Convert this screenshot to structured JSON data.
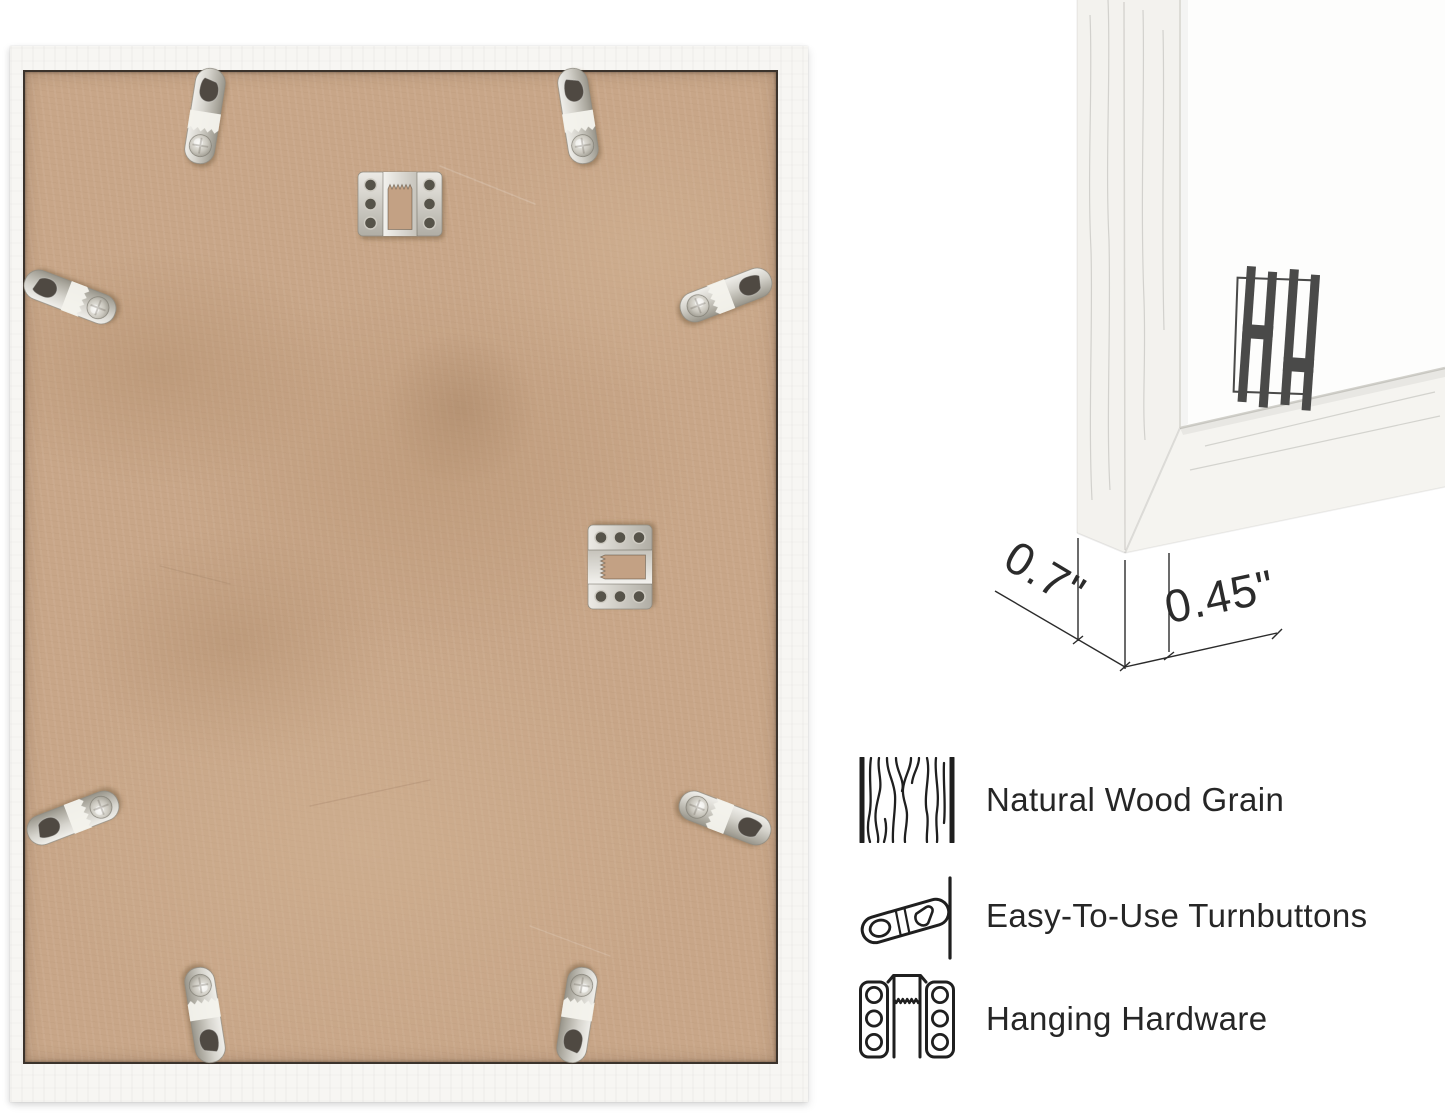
{
  "page": {
    "background_color": "#ffffff"
  },
  "back_view_photo": {
    "description": "back of picture frame with mounting hardware",
    "frame_color": "#f7f6f3",
    "backing_color": "#c8a688",
    "edge_line_color": "#3b332c",
    "hardware_metal_color": "#c9c7c1",
    "turnbutton_count": 8,
    "sawtooth_hanger_count": 2
  },
  "corner_photo": {
    "description": "frame corner close-up with dimensions",
    "frame_color": "#f4f3ef",
    "mat_color": "#fdfdfc",
    "logo": {
      "name": "HH monogram",
      "color": "#4a4a49"
    },
    "dimensions": {
      "depth_label": "0.7\"",
      "face_label": "0.45\""
    },
    "line_color": "#2b2b2b"
  },
  "features": {
    "text_color": "#262626",
    "icon_color": "#1f1f1f",
    "items": [
      {
        "icon": "wood-grain-icon",
        "label": "Natural Wood Grain"
      },
      {
        "icon": "turnbutton-icon",
        "label": "Easy-To-Use Turnbuttons"
      },
      {
        "icon": "hanging-hardware-icon",
        "label": "Hanging Hardware"
      }
    ]
  }
}
